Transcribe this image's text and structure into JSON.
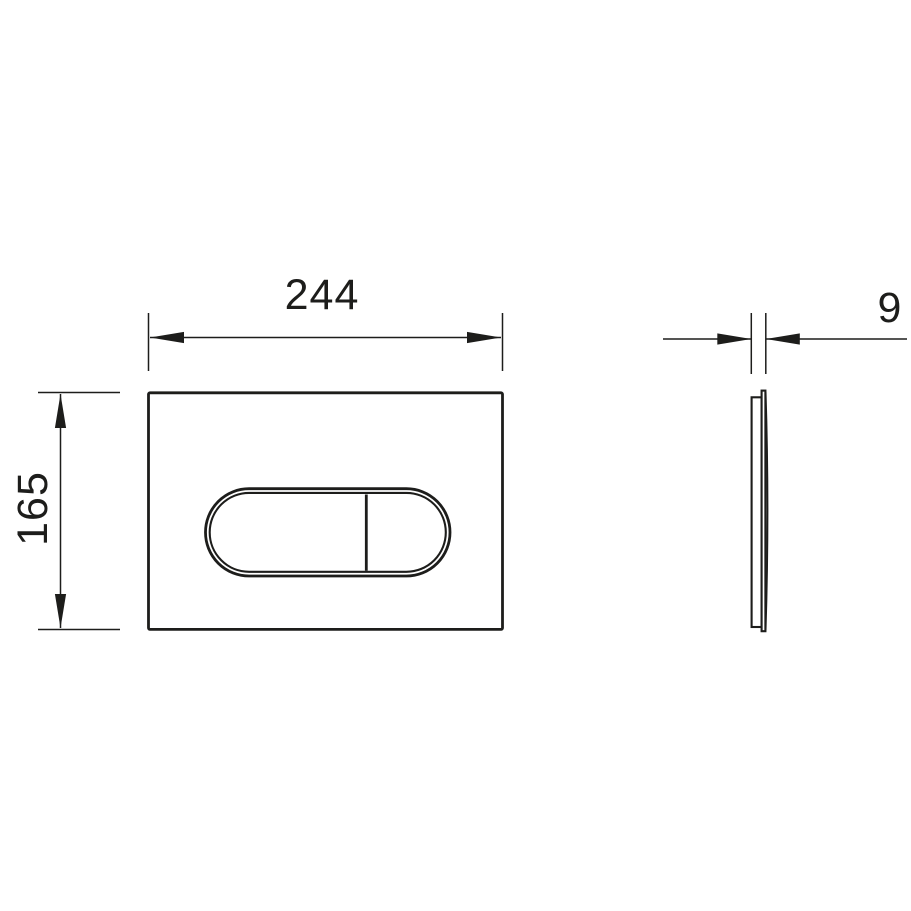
{
  "drawing": {
    "background_color": "#ffffff",
    "line_color": "#1d1d1b",
    "front_view": {
      "width_dimension_label": "244",
      "height_dimension_label": "165"
    },
    "side_view": {
      "thickness_dimension_label": "9"
    }
  }
}
